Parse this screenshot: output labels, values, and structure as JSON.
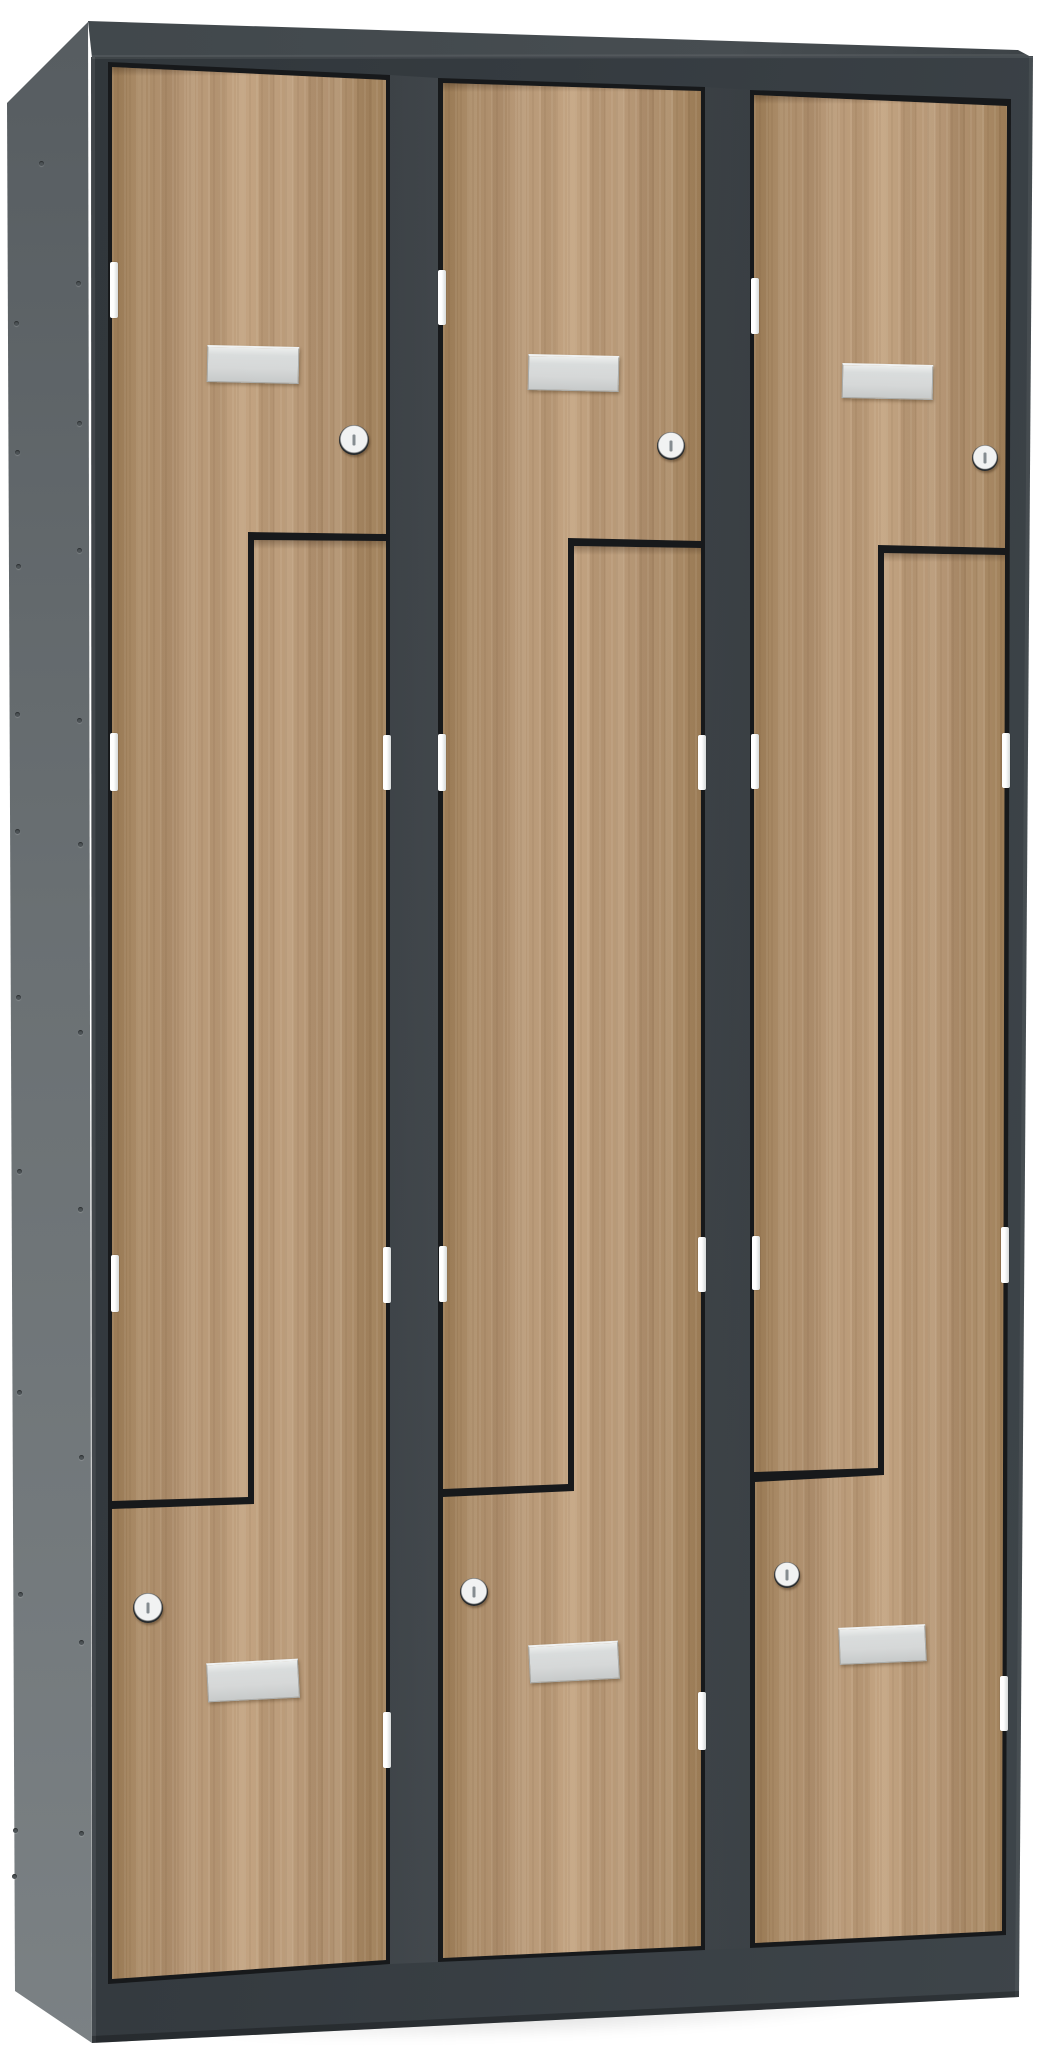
{
  "image": {
    "description": "3D product render of a three-column Z-door wardrobe locker with an anthracite grey steel body and light oak wood-finish doors, viewed slightly from the left on a plain white background",
    "background_color": "#ffffff"
  },
  "locker": {
    "columns": 3,
    "doors_per_column": 2,
    "total_compartments": 6,
    "door_type": "Z-door (angled split doors)",
    "body_color_name": "anthracite grey",
    "door_finish_name": "light oak / beech laminate",
    "hardware": {
      "lock_type": "round cylinder cam lock with vertical key slot",
      "locks_count": 6,
      "name_plates_count": 6,
      "name_plate_state": "blank aluminium label holder",
      "hinges_per_door": 3,
      "hinges_count": 18,
      "side_panel_rivets": true
    }
  },
  "colors": {
    "background": "#ffffff",
    "frame_front": "#353b40",
    "frame_front_light": "#3e454a",
    "frame_top": "#40474b",
    "side_panel_light": "#7b8184",
    "side_panel_dark": "#565c60",
    "door_gap": "#17191b",
    "wood_base": "#b29372",
    "wood_light": "#c2a381",
    "wood_dark": "#a1825c",
    "plate_fill": "#d6d8d8",
    "plate_highlight": "#ebedec",
    "plate_shadow": "#a8acac",
    "hinge_metal": "#d6dada",
    "lock_ring": "#24282b",
    "lock_face": "#f1f2f2",
    "lock_slot": "#858c90",
    "rivet": "#4d5356",
    "floor_shadow": "rgba(0,0,0,0.12)"
  }
}
